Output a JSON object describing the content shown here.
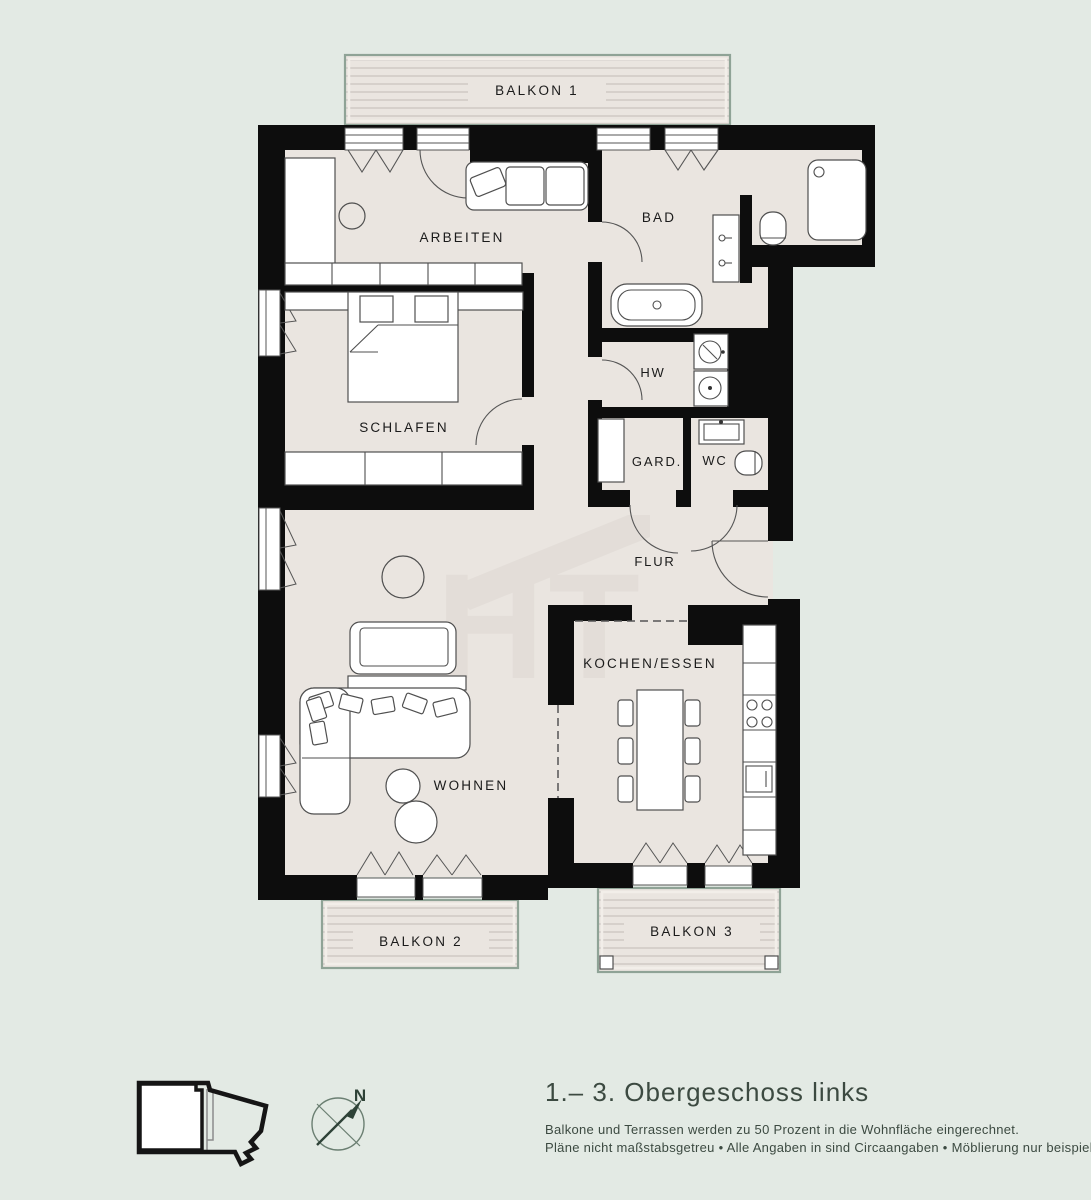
{
  "rooms": {
    "arbeiten": "ARBEITEN",
    "bad": "BAD",
    "schlafen": "SCHLAFEN",
    "hw": "HW",
    "gard": "GARD.",
    "wc": "WC",
    "flur": "FLUR",
    "kochen_essen": "KOCHEN/ESSEN",
    "wohnen": "WOHNEN"
  },
  "balconies": {
    "balkon1": "BALKON 1",
    "balkon2": "BALKON 2",
    "balkon3": "BALKON 3"
  },
  "footer": {
    "title": "1.– 3. Obergeschoss links",
    "note1": "Balkone und Terrassen werden zu 50 Prozent in die Wohnfläche eingerechnet.",
    "note2": "Pläne nicht maßstabsgetreu  •  Alle Angaben in sind Circaangaben  •  Möblierung nur beispielhaft."
  },
  "compass": {
    "north": "N"
  },
  "watermark": {
    "initials": "HT"
  },
  "colors": {
    "background": "#e3eae4",
    "floor": "#eae5e0",
    "wall": "#0d0d0d",
    "balcony_border": "#8fa396",
    "deck_line": "#cbc5c0",
    "furniture_line": "#4f4f4f",
    "label": "#1b1b1b",
    "footer_text": "#3c4a41",
    "compass": "#6b7f72",
    "compass_north": "#2e4237",
    "watermark": "#ded8d3",
    "minimap_outline": "#151515"
  }
}
